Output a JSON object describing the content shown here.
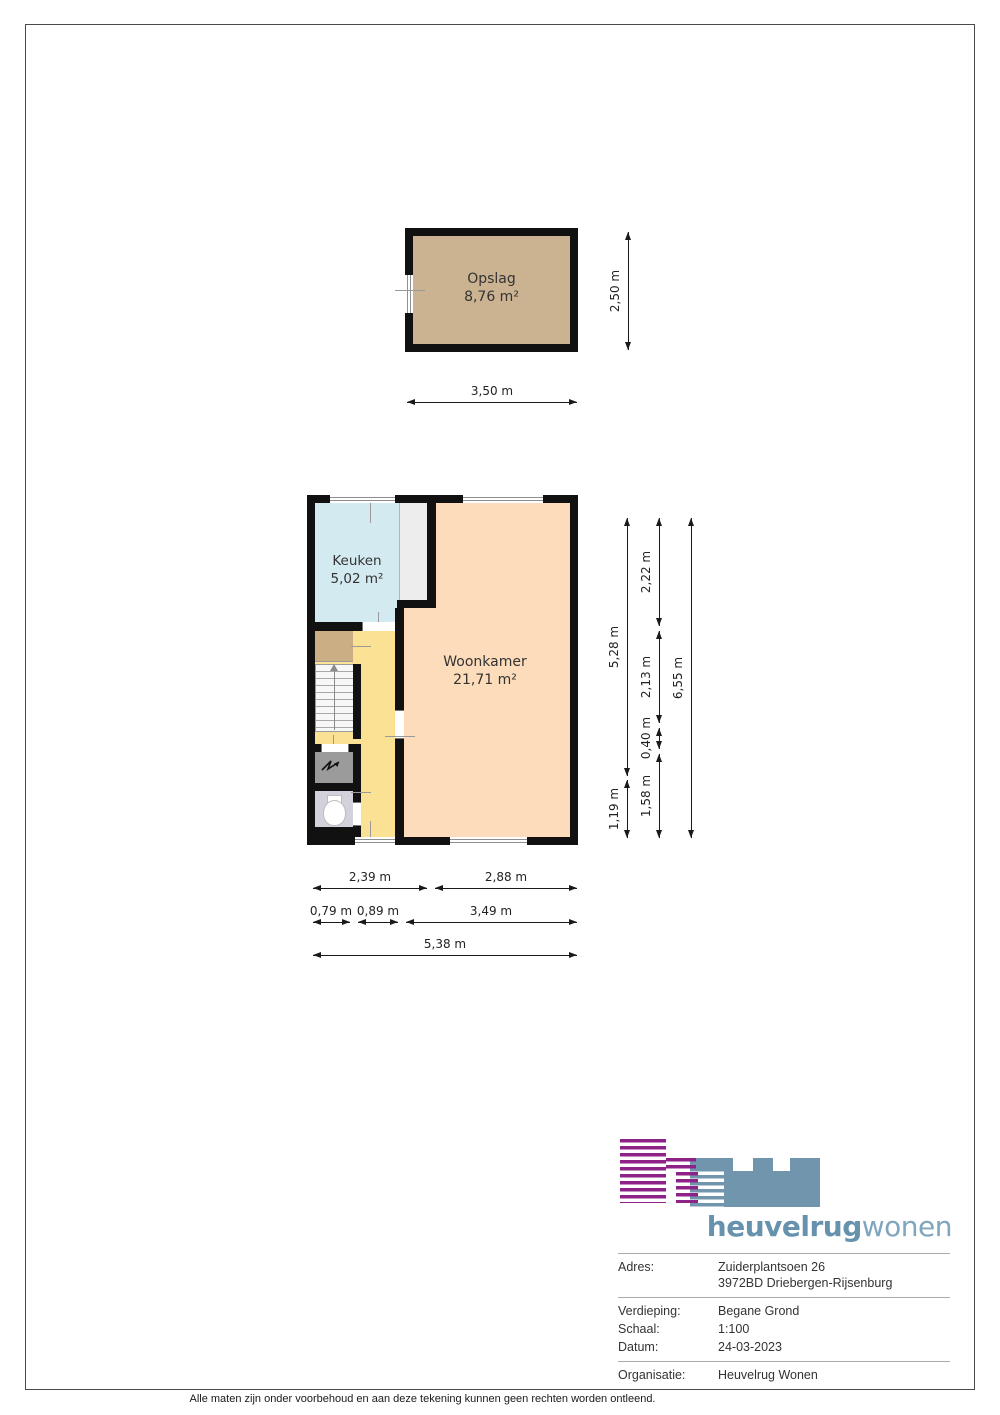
{
  "plans": {
    "storage": {
      "room_name": "Opslag",
      "room_area": "8,76 m²"
    },
    "ground_floor": {
      "kitchen_name": "Keuken",
      "kitchen_area": "5,02 m²",
      "living_name": "Woonkamer",
      "living_area": "21,71 m²"
    }
  },
  "dims": {
    "storage_h": "2,50 m",
    "storage_w": "3,50 m",
    "gf_right_upper": "5,28 m",
    "gf_right_lower": "1,19 m",
    "gf_right_a": "2,22 m",
    "gf_right_b": "2,13 m",
    "gf_right_c": "0,40 m",
    "gf_right_d": "1,58 m",
    "gf_right_total": "6,55 m",
    "gf_bottom_r1a": "2,39 m",
    "gf_bottom_r1b": "2,88 m",
    "gf_bottom_r2a": "0,79 m",
    "gf_bottom_r2b": "0,89 m",
    "gf_bottom_r2c": "3,49 m",
    "gf_bottom_total": "5,38 m"
  },
  "logo": {
    "brand_bold": "heuvelrug",
    "brand_light": "wonen"
  },
  "info": {
    "adres_label": "Adres:",
    "adres_value1": "Zuiderplantsoen 26",
    "adres_value2": "3972BD Driebergen-Rijsenburg",
    "verdieping_label": "Verdieping:",
    "verdieping_value": "Begane Grond",
    "schaal_label": "Schaal:",
    "schaal_value": "1:100",
    "datum_label": "Datum:",
    "datum_value": "24-03-2023",
    "organisatie_label": "Organisatie:",
    "organisatie_value": "Heuvelrug Wonen"
  },
  "footer": {
    "disclaimer": "Alle maten zijn onder voorbehoud en aan deze tekening kunnen geen rechten worden ontleend."
  },
  "colors": {
    "wall": "#111111",
    "storage_fill": "#cbb392",
    "kitchen_fill": "#d4eaf1",
    "living_fill": "#fcdcba",
    "hall_fill": "#fbe193",
    "closet_fill": "#ccae84",
    "toilet_fill": "#d3d2dc",
    "meter_fill": "#9b9b9b",
    "logo_purple": "#8d2287",
    "logo_blue": "#7295ae"
  }
}
